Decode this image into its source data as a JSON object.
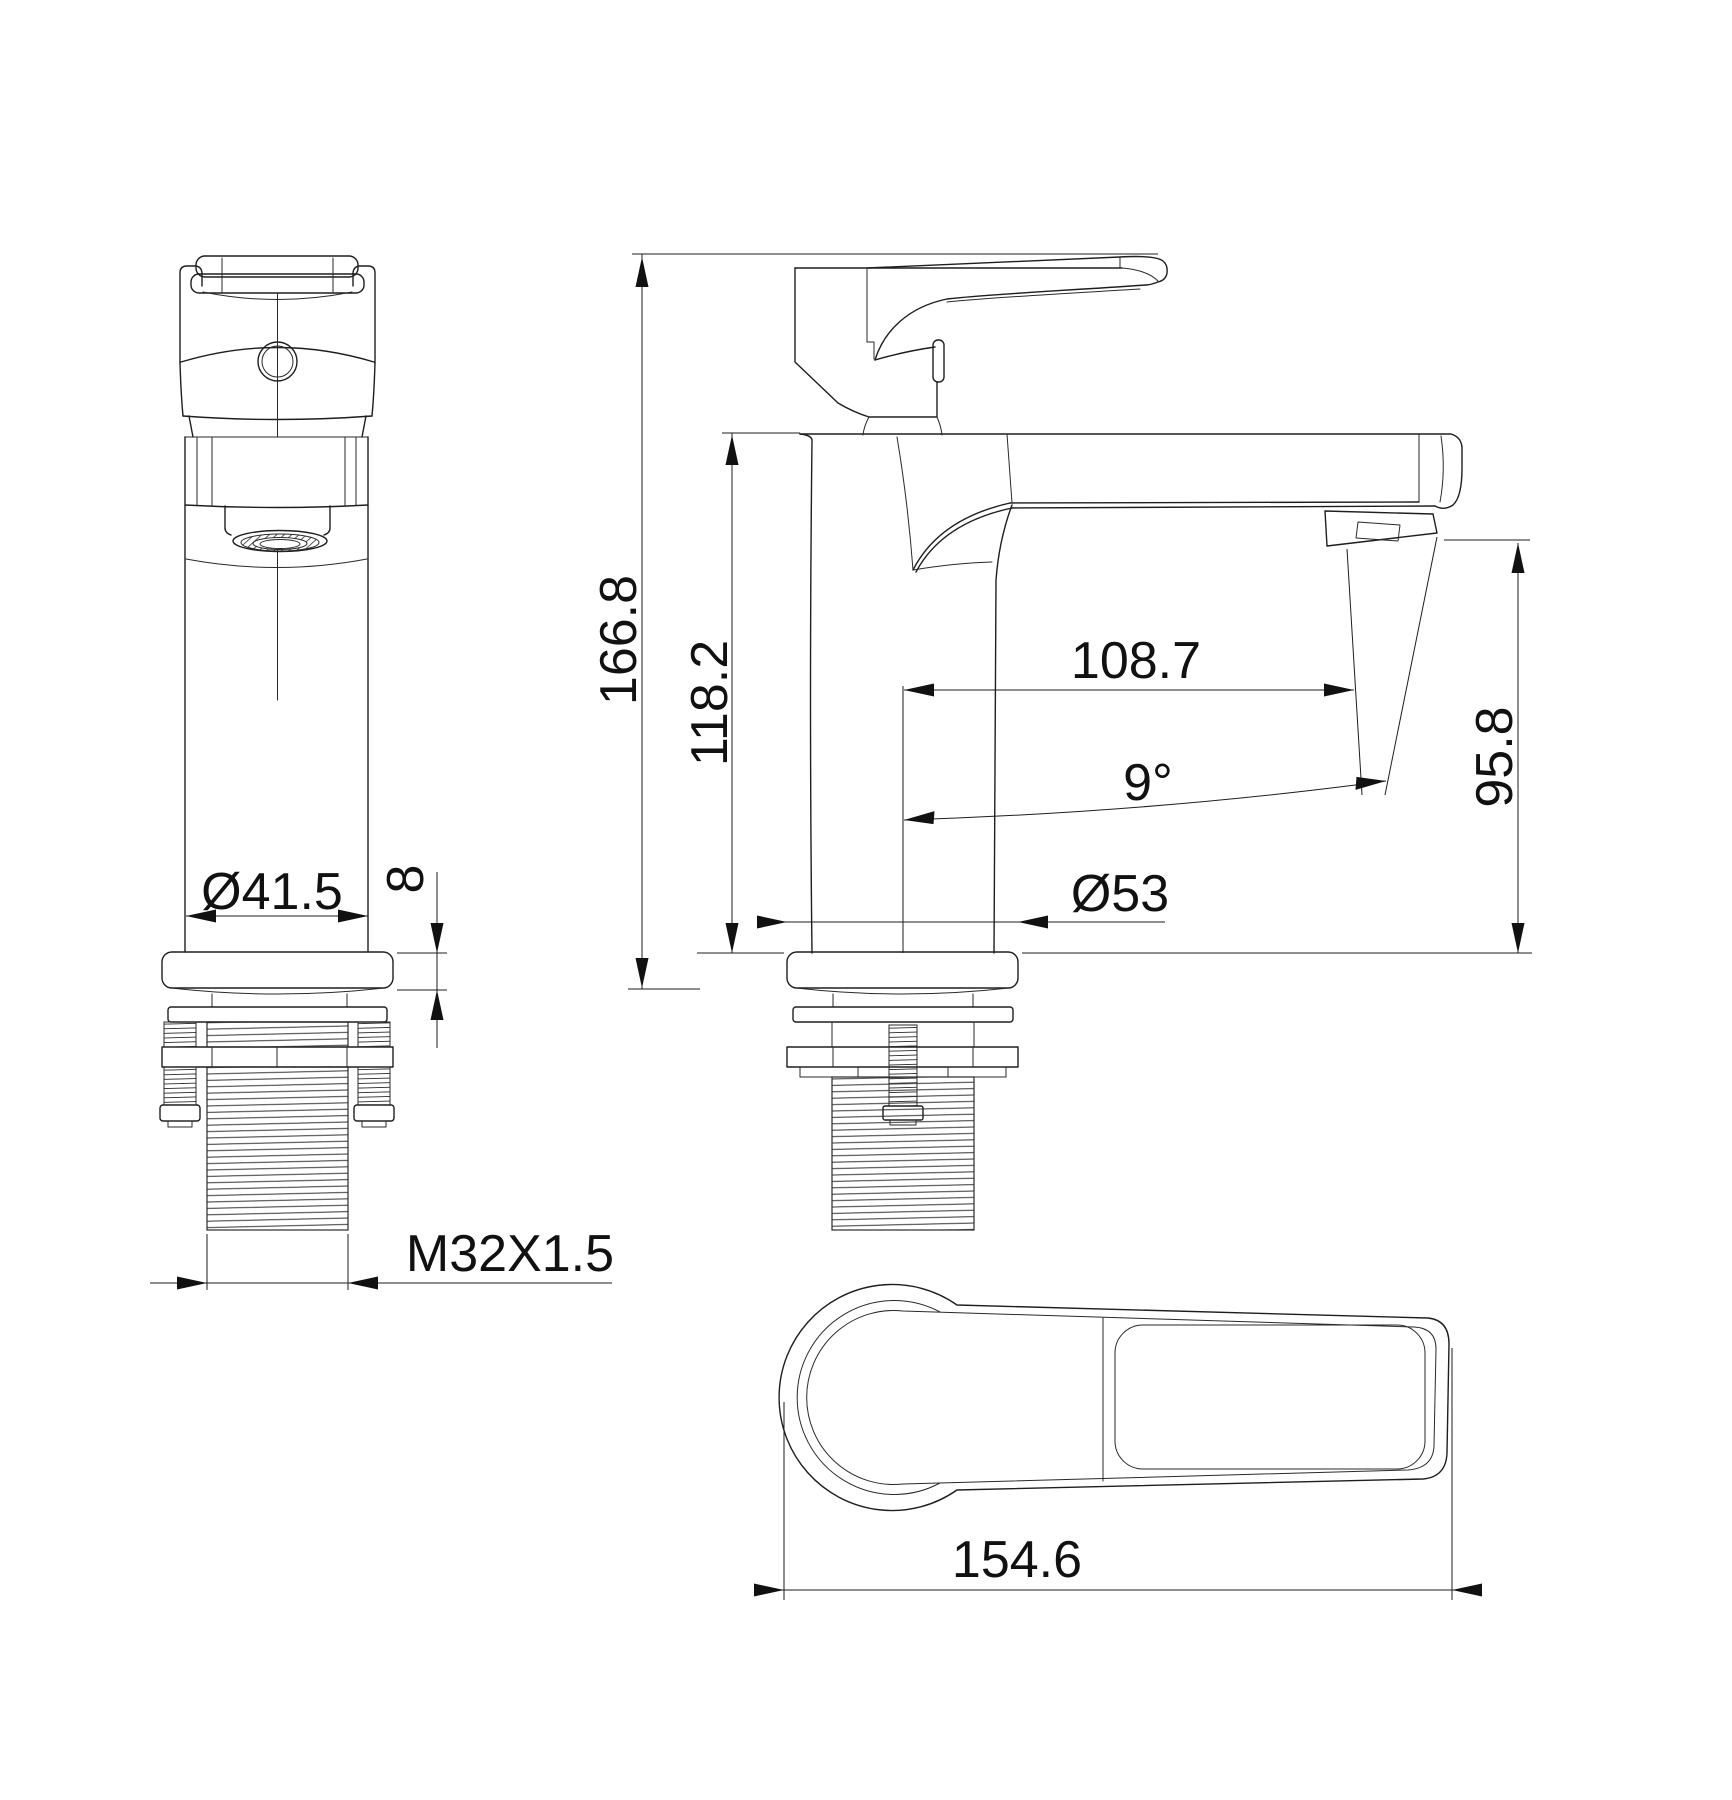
{
  "drawing": {
    "background": "#ffffff",
    "line_color": "#1e1e1e",
    "views": {
      "front": {
        "dims": {
          "body_diameter": "Ø41.5",
          "flange_thickness": "8",
          "thread_spec": "M32X1.5"
        }
      },
      "side": {
        "dims": {
          "overall_height": "166.8",
          "body_height": "118.2",
          "spout_reach": "108.7",
          "spout_angle": "9°",
          "outlet_height": "95.8",
          "base_diameter": "Ø53"
        }
      },
      "top": {
        "dims": {
          "handle_length": "154.6"
        }
      }
    }
  }
}
